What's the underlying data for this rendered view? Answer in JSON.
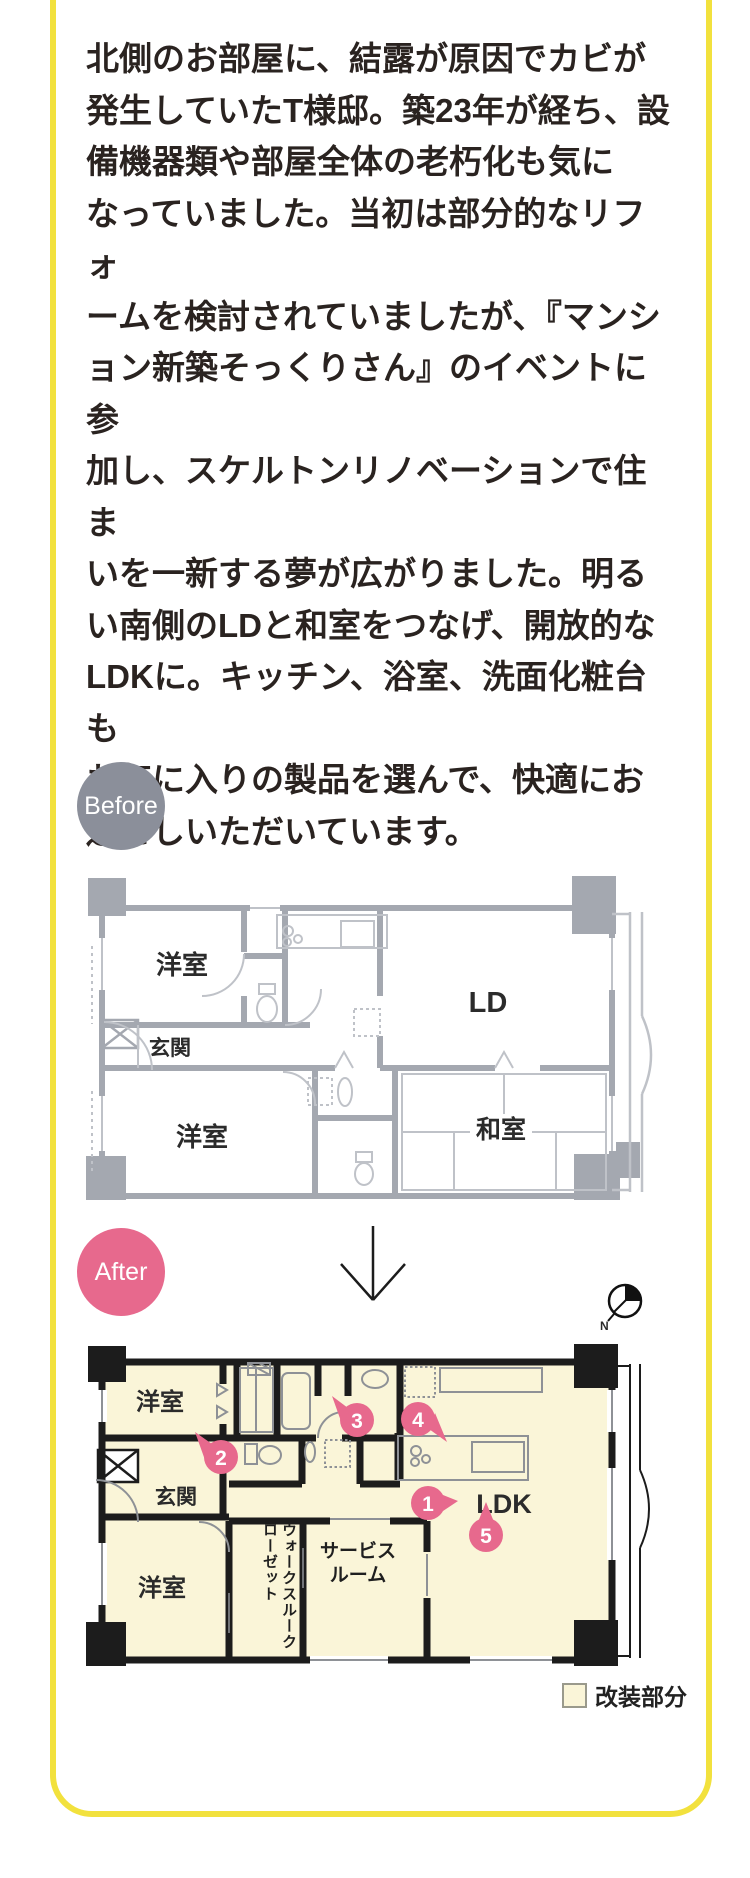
{
  "card": {
    "border_color": "#f2e13d",
    "background": "#ffffff"
  },
  "article": {
    "text": "北側のお部屋に、結露が原因でカビが\n発生していたT様邸。築23年が経ち、設\n備機器類や部屋全体の老朽化も気に\nなっていました。当初は部分的なリフォ\nームを検討されていましたが、『マンシ\nョン新築そっくりさん』のイベントに参\n加し、スケルトンリノベーションで住ま\nいを一新する夢が広がりました。明る\nい南側のLDと和室をつなげ、開放的な\nLDKに。キッチン、浴室、洗面化粧台も\nお気に入りの製品を選んで、快適にお\n過ごしいただいています。"
  },
  "before": {
    "badge_label": "Before",
    "badge_color": "#8b8f9a",
    "plan_line_color": "#a4a8b0",
    "rooms": {
      "bedroom_top": "洋室",
      "entrance": "玄関",
      "bedroom_bottom": "洋室",
      "living_dining": "LD",
      "japanese_room": "和室"
    }
  },
  "after": {
    "badge_label": "After",
    "badge_color": "#e7698d",
    "wall_color": "#1c1c1c",
    "renovated_fill": "#faf5d8",
    "marker_color": "#e7698d",
    "rooms": {
      "bedroom_top": "洋室",
      "entrance": "玄関",
      "bedroom_bottom": "洋室",
      "walkthrough_closet": "ウォークスルークローゼット",
      "service_room": "サービス\nルーム",
      "ldk": "LDK"
    },
    "markers": {
      "m1": "1",
      "m2": "2",
      "m3": "3",
      "m4": "4",
      "m5": "5"
    },
    "compass_label": "N"
  },
  "legend": {
    "label": "改装部分",
    "swatch_color": "#faf5d8"
  }
}
